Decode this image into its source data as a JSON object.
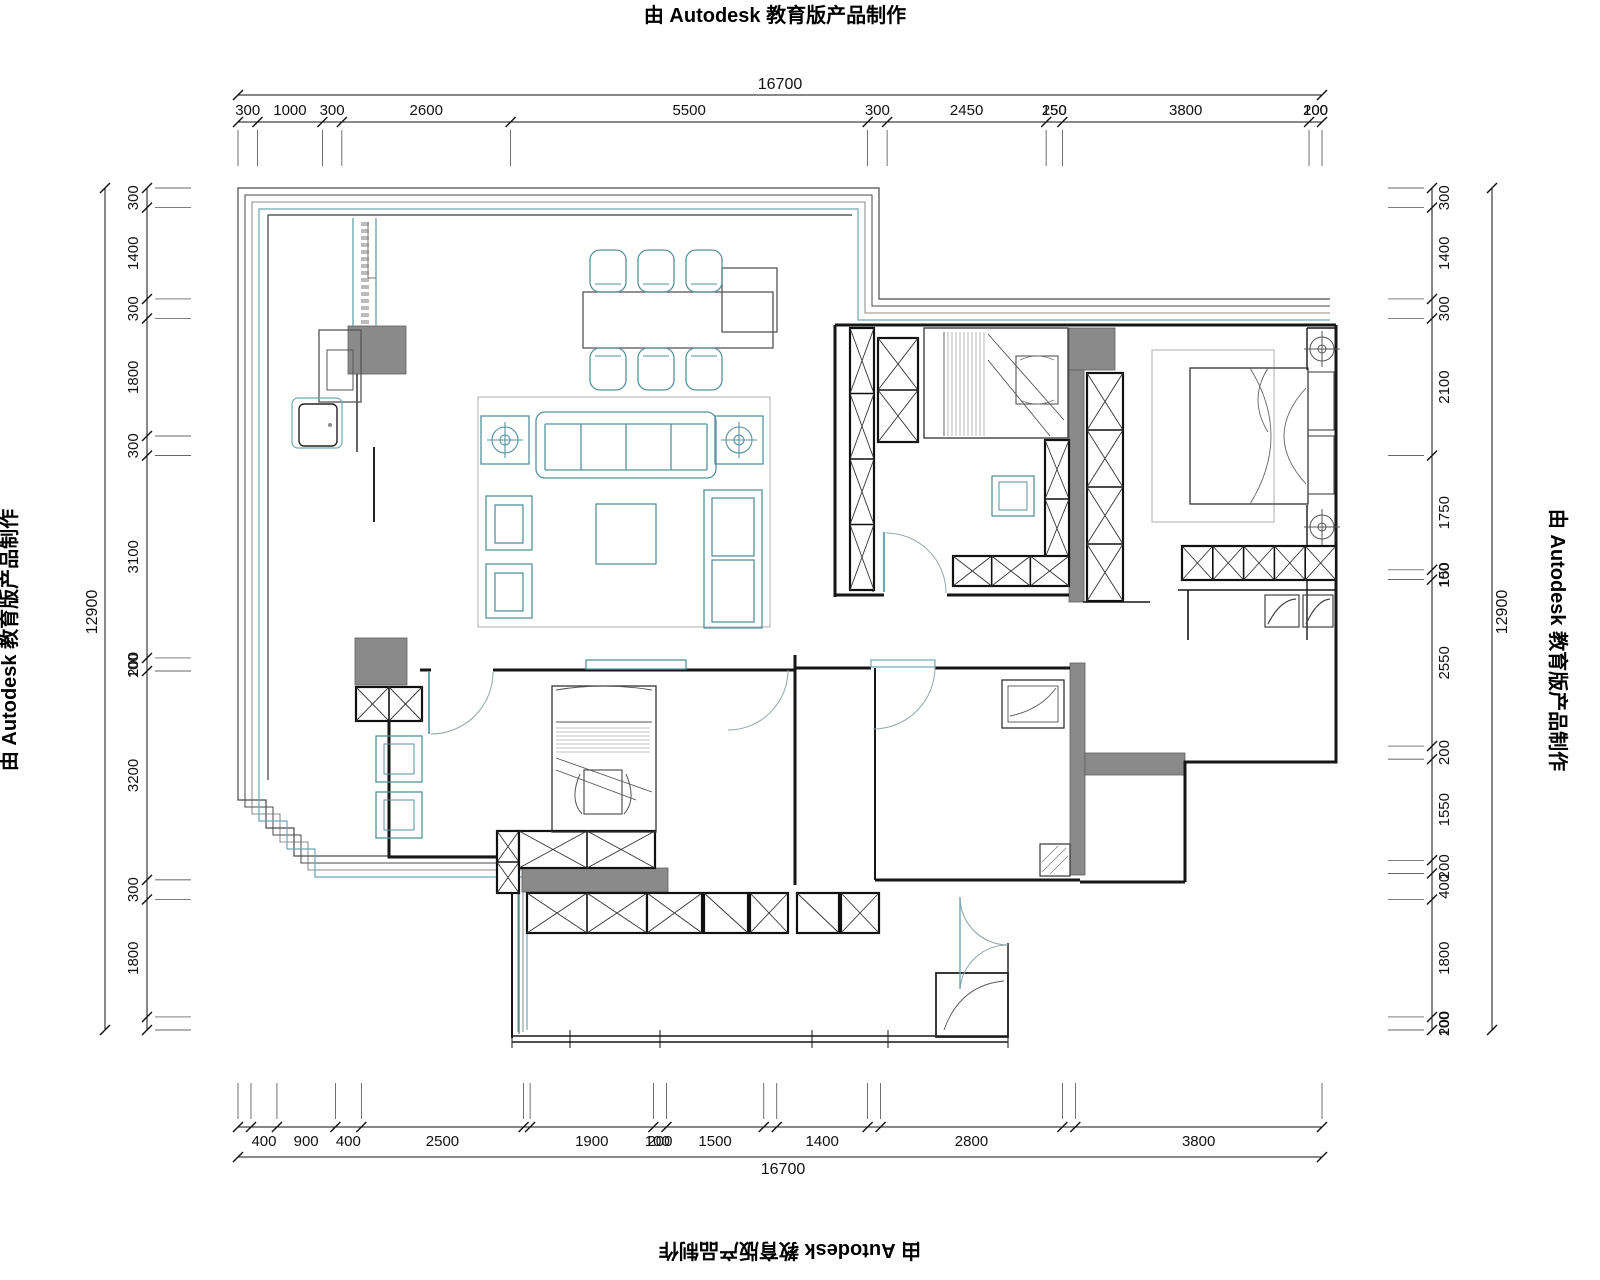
{
  "watermark": {
    "text": "由 Autodesk 教育版产品制作"
  },
  "dimensions": {
    "top": {
      "total": "16700",
      "segments": [
        {
          "v": 300,
          "l": "300"
        },
        {
          "v": 1000,
          "l": "1000"
        },
        {
          "v": 300,
          "l": "300"
        },
        {
          "v": 2600,
          "l": "2600"
        },
        {
          "v": 5500,
          "l": "5500"
        },
        {
          "v": 300,
          "l": "300"
        },
        {
          "v": 2450,
          "l": "2450"
        },
        {
          "v": 250,
          "l": "250"
        },
        {
          "v": 3800,
          "l": "3800"
        },
        {
          "v": 200,
          "l": "200"
        }
      ],
      "overlays": [
        {
          "l": "150",
          "mm": 12575
        },
        {
          "l": "100",
          "mm": 16600
        }
      ]
    },
    "bottom": {
      "total": "16700",
      "segments": [
        {
          "v": 200,
          "l": ""
        },
        {
          "v": 400,
          "l": "400"
        },
        {
          "v": 900,
          "l": "900"
        },
        {
          "v": 400,
          "l": "400"
        },
        {
          "v": 2500,
          "l": "2500"
        },
        {
          "v": 100,
          "l": ""
        },
        {
          "v": 1900,
          "l": "1900"
        },
        {
          "v": 200,
          "l": "200"
        },
        {
          "v": 1500,
          "l": "1500"
        },
        {
          "v": 200,
          "l": ""
        },
        {
          "v": 1400,
          "l": "1400"
        },
        {
          "v": 200,
          "l": ""
        },
        {
          "v": 2800,
          "l": "2800"
        },
        {
          "v": 200,
          "l": ""
        },
        {
          "v": 3800,
          "l": "3800"
        }
      ],
      "overlays": [
        {
          "l": "100",
          "mm": 6460
        }
      ]
    },
    "left": {
      "total": "12900",
      "segments": [
        {
          "v": 300,
          "l": "300"
        },
        {
          "v": 1400,
          "l": "1400"
        },
        {
          "v": 300,
          "l": "300"
        },
        {
          "v": 1800,
          "l": "1800"
        },
        {
          "v": 300,
          "l": "300"
        },
        {
          "v": 3100,
          "l": "3100"
        },
        {
          "v": 200,
          "l": "200"
        },
        {
          "v": 3200,
          "l": "3200"
        },
        {
          "v": 300,
          "l": "300"
        },
        {
          "v": 1800,
          "l": "1800"
        },
        {
          "v": 200,
          "l": ""
        }
      ],
      "overlays": [
        {
          "l": "100",
          "mm": 7320
        }
      ]
    },
    "right": {
      "total": "12900",
      "segments": [
        {
          "v": 300,
          "l": "300"
        },
        {
          "v": 1400,
          "l": "1400"
        },
        {
          "v": 300,
          "l": "300"
        },
        {
          "v": 2100,
          "l": "2100"
        },
        {
          "v": 1750,
          "l": "1750"
        },
        {
          "v": 150,
          "l": "150"
        },
        {
          "v": 2550,
          "l": "2550"
        },
        {
          "v": 200,
          "l": "200"
        },
        {
          "v": 1550,
          "l": "1550"
        },
        {
          "v": 200,
          "l": "200"
        },
        {
          "v": 400,
          "l": "400"
        },
        {
          "v": 1800,
          "l": "1800"
        },
        {
          "v": 200,
          "l": "200"
        }
      ],
      "overlays": [
        {
          "l": "100",
          "mm": 5935
        },
        {
          "l": "100",
          "mm": 12810
        }
      ]
    }
  }
}
